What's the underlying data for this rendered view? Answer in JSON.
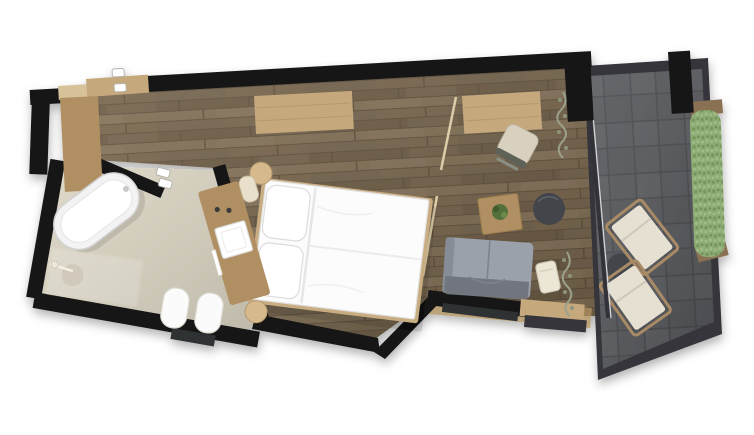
{
  "scene": {
    "kind": "architectural-floor-plan",
    "view": "top-down",
    "background": "#ffffff",
    "rooms": [
      {
        "name": "bathroom",
        "floor": "beige-stone"
      },
      {
        "name": "bedroom",
        "floor": "dark-wood-planks"
      },
      {
        "name": "terrace",
        "floor": "dark-slate-tiles"
      }
    ],
    "bathroom_items": [
      "bathtub",
      "walk-in-shower",
      "shower-drain",
      "shower-fixture",
      "vanity-counter",
      "sink",
      "faucet",
      "towel-bar",
      "toilet",
      "bidet",
      "door-handle"
    ],
    "bedroom_items": [
      "entry-door",
      "door-handle",
      "wardrobe",
      "sideboard",
      "desk",
      "desk-chair",
      "curtain-pole",
      "curtain-pole",
      "double-bed",
      "pillow",
      "pillow",
      "nightstand",
      "nightstand",
      "coffee-table-with-plant",
      "pouf",
      "sofa",
      "side-table",
      "hanging-plant",
      "hanging-plant",
      "terrace-threshold"
    ],
    "terrace_items": [
      "lounge-chair",
      "lounge-chair",
      "round-side-table",
      "hedge-planter",
      "planter-cap",
      "planter-cap"
    ]
  },
  "colors": {
    "wall": "#141414",
    "wall-window": "#2e3033",
    "wood": "#75634a",
    "wood-light": "#7e6c52",
    "wood-dark": "#6a5942",
    "wood-line": "#5d4e3a",
    "bath-floor": "#dbd5c3",
    "tile": "#55575b",
    "tile-alt": "#5b5d61",
    "tile-line": "#46484c",
    "frame": "#34363a",
    "glass": "#303338",
    "furn-wood": "#c5a87c",
    "furn-wood-dark": "#b08f63",
    "furn-wood-light": "#d8c29a",
    "white": "#fbfbfb",
    "sofa": "#9aa1aa",
    "sofa-dark": "#6f757e",
    "sofa-arm": "#868d97",
    "pouf": "#42454a",
    "cushion": "#e6e0d2",
    "lounger-frame": "#a98a66",
    "hedge": "#8cab74",
    "hedge-dark": "#769659",
    "planter": "#8b7153",
    "plant": "#55703c",
    "plant-dark": "#425c2e",
    "vine": "#9aa089"
  }
}
